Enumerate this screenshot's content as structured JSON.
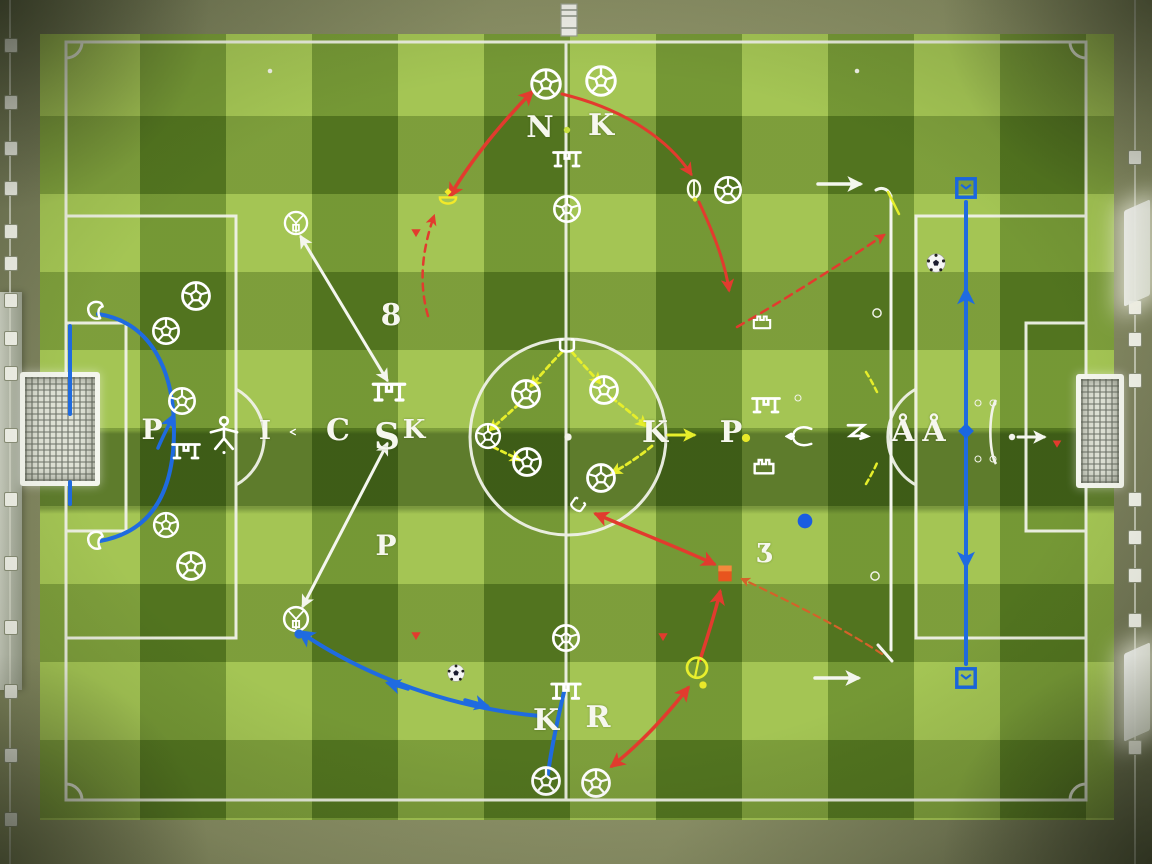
{
  "board": {
    "description": "Aerial soccer pitch tactics diagram with drawn arrows, balls, cones and letter tokens",
    "colors": {
      "grass_light": "#9cbf45",
      "grass_dark": "#4e6b1c",
      "line_white": "#f2f4ea",
      "arrow_red": "#e23b2e",
      "arrow_orange": "#d4622a",
      "arrow_blue": "#1f6be0",
      "arrow_yellow": "#e6ee2b",
      "arrow_white": "#f4f6ee",
      "marker_orange_square": "#e8541e",
      "marker_blue": "#1a67e0",
      "cone_yellow": "#f2e92a"
    }
  },
  "letters": [
    {
      "ch": "N",
      "x": 540,
      "y": 128,
      "s": 30
    },
    {
      "ch": "K",
      "x": 601,
      "y": 126,
      "s": 30
    },
    {
      "ch": "8",
      "x": 391,
      "y": 316,
      "s": 30
    },
    {
      "ch": "I",
      "x": 265,
      "y": 431,
      "s": 26
    },
    {
      "ch": "C",
      "x": 338,
      "y": 431,
      "s": 30
    },
    {
      "ch": "S",
      "x": 387,
      "y": 437,
      "s": 36
    },
    {
      "ch": "K",
      "x": 414,
      "y": 430,
      "s": 26
    },
    {
      "ch": "P",
      "x": 152,
      "y": 430,
      "s": 28
    },
    {
      "ch": "K",
      "x": 655,
      "y": 433,
      "s": 30
    },
    {
      "ch": "P",
      "x": 731,
      "y": 433,
      "s": 30
    },
    {
      "ch": "Å",
      "x": 903,
      "y": 432,
      "s": 30
    },
    {
      "ch": "Å",
      "x": 934,
      "y": 432,
      "s": 30
    },
    {
      "ch": "Ʒ",
      "x": 765,
      "y": 554,
      "s": 26
    },
    {
      "ch": "P",
      "x": 386,
      "y": 546,
      "s": 28
    },
    {
      "ch": "K",
      "x": 546,
      "y": 721,
      "s": 30
    },
    {
      "ch": "R",
      "x": 598,
      "y": 718,
      "s": 30
    }
  ],
  "icons": [
    {
      "t": "ball",
      "x": 546,
      "y": 84,
      "s": 36
    },
    {
      "t": "ball",
      "x": 601,
      "y": 81,
      "s": 36
    },
    {
      "t": "ball",
      "x": 567,
      "y": 209,
      "s": 32
    },
    {
      "t": "ball",
      "x": 196,
      "y": 296,
      "s": 34
    },
    {
      "t": "ball",
      "x": 166,
      "y": 331,
      "s": 32
    },
    {
      "t": "ball",
      "x": 182,
      "y": 401,
      "s": 32
    },
    {
      "t": "ball",
      "x": 166,
      "y": 525,
      "s": 30
    },
    {
      "t": "ball",
      "x": 191,
      "y": 566,
      "s": 34
    },
    {
      "t": "ball",
      "x": 488,
      "y": 436,
      "s": 30
    },
    {
      "t": "ball",
      "x": 526,
      "y": 394,
      "s": 34
    },
    {
      "t": "ball",
      "x": 604,
      "y": 390,
      "s": 34
    },
    {
      "t": "ball",
      "x": 527,
      "y": 462,
      "s": 34
    },
    {
      "t": "ball",
      "x": 601,
      "y": 478,
      "s": 34
    },
    {
      "t": "ball",
      "x": 566,
      "y": 638,
      "s": 32
    },
    {
      "t": "ball",
      "x": 546,
      "y": 781,
      "s": 34
    },
    {
      "t": "ball",
      "x": 596,
      "y": 783,
      "s": 34
    },
    {
      "t": "ball",
      "x": 728,
      "y": 190,
      "s": 32
    },
    {
      "t": "cubeball",
      "x": 296,
      "y": 223,
      "s": 28
    },
    {
      "t": "cubeball",
      "x": 296,
      "y": 619,
      "s": 30
    },
    {
      "t": "realball",
      "x": 936,
      "y": 263,
      "s": 22
    },
    {
      "t": "realball",
      "x": 456,
      "y": 673,
      "s": 20
    },
    {
      "t": "gate",
      "x": 567,
      "y": 160,
      "s": 36
    },
    {
      "t": "gate",
      "x": 389,
      "y": 393,
      "s": 42
    },
    {
      "t": "gate",
      "x": 186,
      "y": 452,
      "s": 36
    },
    {
      "t": "gate",
      "x": 566,
      "y": 692,
      "s": 38
    },
    {
      "t": "gate",
      "x": 766,
      "y": 406,
      "s": 36
    },
    {
      "t": "castle",
      "x": 764,
      "y": 464,
      "s": 32
    },
    {
      "t": "castle",
      "x": 762,
      "y": 320,
      "s": 28
    },
    {
      "t": "person",
      "x": 224,
      "y": 434,
      "s": 42
    },
    {
      "t": "cup",
      "x": 567,
      "y": 347,
      "s": 30
    },
    {
      "t": "cup",
      "x": 577,
      "y": 506,
      "s": 26,
      "r": 35
    },
    {
      "t": "blob",
      "x": 97,
      "y": 312,
      "s": 30
    },
    {
      "t": "blob",
      "x": 97,
      "y": 542,
      "s": 30
    },
    {
      "t": "coneY",
      "x": 448,
      "y": 198,
      "s": 28
    },
    {
      "t": "oval",
      "x": 694,
      "y": 189,
      "s": 28
    },
    {
      "t": "ringY",
      "x": 697,
      "y": 669,
      "s": 30
    },
    {
      "t": "tri",
      "x": 416,
      "y": 233,
      "s": 14,
      "c": "#e23b2e"
    },
    {
      "t": "tri",
      "x": 416,
      "y": 636,
      "s": 14,
      "c": "#e23b2e"
    },
    {
      "t": "tri",
      "x": 663,
      "y": 637,
      "s": 14,
      "c": "#e23b2e"
    },
    {
      "t": "tri",
      "x": 1057,
      "y": 444,
      "s": 13,
      "c": "#e23b2e"
    },
    {
      "t": "dot",
      "x": 746,
      "y": 438,
      "s": 9,
      "c": "#e8e82a"
    },
    {
      "t": "dot",
      "x": 703,
      "y": 685,
      "s": 8,
      "c": "#e8e82a"
    },
    {
      "t": "dot",
      "x": 567,
      "y": 130,
      "s": 7,
      "c": "#c8e040"
    },
    {
      "t": "dot",
      "x": 805,
      "y": 521,
      "s": 16,
      "c": "#1a5de0"
    },
    {
      "t": "dot",
      "x": 299,
      "y": 634,
      "s": 10,
      "c": "#1f6be0"
    },
    {
      "t": "dot",
      "x": 270,
      "y": 71,
      "s": 5,
      "c": "#f2f3ea"
    },
    {
      "t": "dot",
      "x": 857,
      "y": 71,
      "s": 5,
      "c": "#f2f3ea"
    },
    {
      "t": "dot",
      "x": 1012,
      "y": 437,
      "s": 7,
      "c": "#f2f3ea"
    },
    {
      "t": "dot",
      "x": 568,
      "y": 437,
      "s": 8,
      "c": "#f2f3ea"
    },
    {
      "t": "sq",
      "x": 725,
      "y": 573,
      "s": 20
    },
    {
      "t": "sqo",
      "x": 966,
      "y": 188,
      "s": 26
    },
    {
      "t": "sqo",
      "x": 966,
      "y": 678,
      "s": 26
    },
    {
      "t": "diamond",
      "x": 966,
      "y": 431,
      "s": 20
    },
    {
      "t": "ring",
      "x": 798,
      "y": 398,
      "s": 8
    },
    {
      "t": "ring",
      "x": 877,
      "y": 313,
      "s": 11
    },
    {
      "t": "ring",
      "x": 875,
      "y": 576,
      "s": 11
    },
    {
      "t": "ring",
      "x": 978,
      "y": 403,
      "s": 8
    },
    {
      "t": "ring",
      "x": 993,
      "y": 403,
      "s": 8
    },
    {
      "t": "ring",
      "x": 978,
      "y": 459,
      "s": 8
    },
    {
      "t": "ring",
      "x": 993,
      "y": 459,
      "s": 8
    },
    {
      "t": "fish",
      "x": 800,
      "y": 437,
      "s": 30
    },
    {
      "t": "flagz",
      "x": 858,
      "y": 434,
      "s": 30
    },
    {
      "t": "brace",
      "x": 992,
      "y": 432,
      "s": 24
    },
    {
      "t": "winglet",
      "x": 296,
      "y": 432,
      "s": 16
    },
    {
      "t": "bench",
      "x": 569,
      "y": 20,
      "s": 24
    }
  ],
  "arrows": [
    {
      "d": "M450,196 C472,158 506,118 532,92",
      "c": "red",
      "w": 3.5,
      "ms": 1,
      "me": 1
    },
    {
      "d": "M562,94 C628,110 670,142 691,174",
      "c": "red",
      "w": 3,
      "me": 1
    },
    {
      "d": "M699,202 C713,232 725,262 729,290",
      "c": "red",
      "w": 3,
      "me": 1
    },
    {
      "d": "M737,327 C784,300 844,262 884,235",
      "c": "red",
      "w": 2.5,
      "dash": "8 6",
      "me": 1
    },
    {
      "d": "M428,316 C420,288 420,256 434,216",
      "c": "red",
      "w": 2.5,
      "dash": "7 6",
      "me": 1
    },
    {
      "d": "M596,514 C638,532 684,550 714,564",
      "c": "red",
      "w": 3.5,
      "ms": 1,
      "me": 1
    },
    {
      "d": "M700,660 C707,638 715,614 720,592",
      "c": "red",
      "w": 3.5,
      "me": 1
    },
    {
      "d": "M612,766 C640,744 666,716 688,688",
      "c": "red",
      "w": 3.5,
      "ms": 1,
      "me": 1
    },
    {
      "d": "M882,654 C838,625 778,596 742,579",
      "c": "orange",
      "w": 2.2,
      "dash": "7 5",
      "me": 1
    },
    {
      "d": "M301,237 L387,380",
      "c": "white",
      "w": 3,
      "ms": 1,
      "me": 1
    },
    {
      "d": "M387,444 L303,606",
      "c": "white",
      "w": 3,
      "ms": 1,
      "me": 1
    },
    {
      "d": "M818,184 L860,184",
      "c": "white",
      "w": 3.5,
      "me": 1
    },
    {
      "d": "M891,196 L891,650",
      "c": "white",
      "w": 3
    },
    {
      "d": "M891,198 C890,190 883,186 876,190",
      "c": "white",
      "w": 3
    },
    {
      "d": "M878,645 L892,661",
      "c": "white",
      "w": 3
    },
    {
      "d": "M815,678 L858,678",
      "c": "white",
      "w": 3.5,
      "me": 1
    },
    {
      "d": "M1018,437 L1044,437",
      "c": "white",
      "w": 3,
      "me": 1
    },
    {
      "d": "M98,314 C152,322 174,372 174,430 C174,494 150,532 100,541",
      "c": "blue",
      "w": 4
    },
    {
      "d": "M158,448 C163,436 168,427 173,416",
      "c": "blue",
      "w": 3.5,
      "me": 1
    },
    {
      "d": "M70,326 L70,414",
      "c": "blue",
      "w": 4
    },
    {
      "d": "M70,482 L70,504",
      "c": "blue",
      "w": 4
    },
    {
      "d": "M300,632 C368,678 452,708 540,716",
      "c": "blue",
      "w": 4,
      "ms": 1
    },
    {
      "d": "M408,689 L388,683",
      "c": "blue",
      "w": 3.5,
      "me": 1
    },
    {
      "d": "M465,700 L487,706",
      "c": "blue",
      "w": 3.5,
      "me": 1
    },
    {
      "d": "M564,692 C557,722 551,750 548,774",
      "c": "blue",
      "w": 4
    },
    {
      "d": "M966,202 L966,664",
      "c": "blue",
      "w": 4
    },
    {
      "d": "M966,312 L966,290",
      "c": "blue",
      "w": 4,
      "me": 1
    },
    {
      "d": "M966,542 L966,566",
      "c": "blue",
      "w": 4,
      "me": 1
    },
    {
      "d": "M562,352 C550,364 540,376 531,386",
      "c": "yellow",
      "w": 2.8,
      "dash": "5 4",
      "me": 1
    },
    {
      "d": "M519,404 C508,414 498,423 490,430",
      "c": "yellow",
      "w": 2.8,
      "dash": "5 4",
      "me": 1
    },
    {
      "d": "M493,447 C503,452 512,456 520,460",
      "c": "yellow",
      "w": 2.8,
      "dash": "5 4",
      "me": 1
    },
    {
      "d": "M572,352 C582,364 592,374 600,383",
      "c": "yellow",
      "w": 2.8,
      "dash": "5 4",
      "me": 1
    },
    {
      "d": "M612,398 C625,408 637,418 646,426",
      "c": "yellow",
      "w": 2.8,
      "dash": "5 4",
      "me": 1
    },
    {
      "d": "M652,446 C640,456 625,466 612,473",
      "c": "yellow",
      "w": 2.8,
      "dash": "5 4",
      "me": 1
    },
    {
      "d": "M668,435 L694,435",
      "c": "yellow",
      "w": 3,
      "me": 1
    },
    {
      "d": "M866,372 C871,380 874,386 877,392",
      "c": "yellow",
      "w": 2.5,
      "dash": "5 4"
    },
    {
      "d": "M866,484 C870,477 874,470 877,463",
      "c": "yellow",
      "w": 2.5,
      "dash": "5 4"
    },
    {
      "d": "M888,192 L899,214",
      "c": "yellow",
      "w": 2.5
    }
  ],
  "furniture": {
    "left_rail_clips_y": [
      38,
      95,
      141,
      181,
      224,
      256,
      293,
      331,
      366,
      428,
      492,
      556,
      620,
      684,
      748,
      812
    ],
    "right_rail_clips_y": [
      150,
      300,
      332,
      373,
      492,
      530,
      568,
      613,
      740
    ]
  }
}
